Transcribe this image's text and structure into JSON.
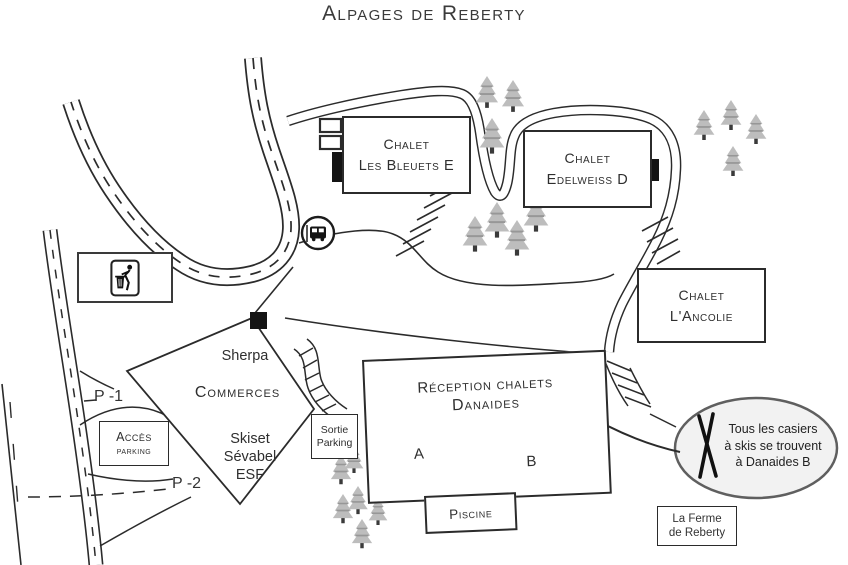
{
  "title": "Alpages de Reberty",
  "buildings": {
    "les_bleuets": {
      "line1": "Chalet",
      "line2": "Les Bleuets E"
    },
    "edelweiss": {
      "line1": "Chalet",
      "line2": "Edelweiss D"
    },
    "ancolie": {
      "line1": "Chalet",
      "line2": "L'Ancolie"
    },
    "reception": {
      "line1": "Réception chalets",
      "line2": "Danaides",
      "unit_a": "A",
      "unit_b": "B"
    },
    "piscine": {
      "label": "Piscine"
    },
    "ferme_reberty": {
      "line1": "La Ferme",
      "line2": "de Reberty"
    },
    "commerces": {
      "label": "Commerces",
      "shop_top": "Sherpa",
      "shop_bottom1": "Skiset",
      "shop_bottom2": "Sévabel",
      "shop_bottom3": "ESF"
    }
  },
  "parking": {
    "acces": {
      "line1": "Accès",
      "line2": "parking"
    },
    "sortie": {
      "line1": "Sortie",
      "line2": "Parking"
    },
    "level1": "P -1",
    "level2": "P -2"
  },
  "callout": {
    "line1": "Tous les casiers",
    "line2": "à skis se trouvent",
    "line3": "à Danaides B"
  },
  "icons": {
    "bus_stop": "bus-stop-icon",
    "litter": "litter-disposal-icon",
    "skis": "crossed-skis-icon",
    "tree": "pine-tree-icon"
  },
  "colors": {
    "ink": "#2b2b2b",
    "tree": "#bdbdbd",
    "callout_fill": "#f2f2f2",
    "marker": "#141414"
  }
}
